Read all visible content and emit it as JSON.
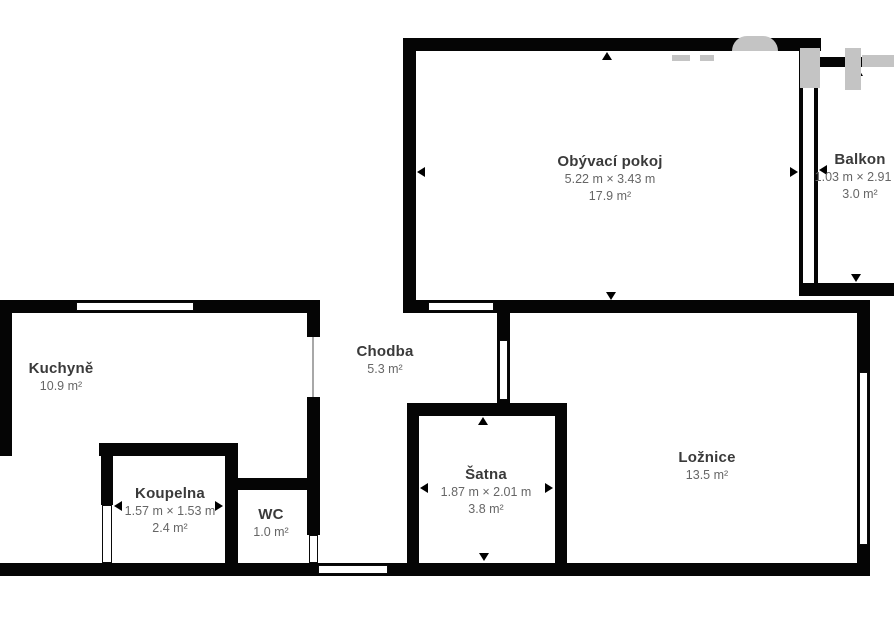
{
  "rooms": [
    {
      "id": "obyvaci-pokoj",
      "name": "Obývací pokoj",
      "dims": "5.22 m × 3.43 m",
      "area": "17.9 m²"
    },
    {
      "id": "balkon",
      "name": "Balkon",
      "dims": "1.03 m × 2.91 m",
      "area": "3.0 m²"
    },
    {
      "id": "kuchyne",
      "name": "Kuchyně",
      "dims": "",
      "area": "10.9 m²"
    },
    {
      "id": "chodba",
      "name": "Chodba",
      "dims": "",
      "area": "5.3 m²"
    },
    {
      "id": "koupelna",
      "name": "Koupelna",
      "dims": "1.57 m × 1.53 m",
      "area": "2.4 m²"
    },
    {
      "id": "wc",
      "name": "WC",
      "dims": "",
      "area": "1.0 m²"
    },
    {
      "id": "satna",
      "name": "Šatna",
      "dims": "1.87 m × 2.01 m",
      "area": "3.8 m²"
    },
    {
      "id": "loznice",
      "name": "Ložnice",
      "dims": "",
      "area": "13.5 m²"
    }
  ],
  "icons": {
    "dimension_arrow": "dimension-arrow",
    "watermark": "watermark-logo-fragment"
  },
  "colors": {
    "wall": "#050505",
    "background": "#ffffff",
    "room_name_text": "#3a3a3a",
    "dimension_text": "#666666",
    "watermark": "#c4c4c4"
  }
}
